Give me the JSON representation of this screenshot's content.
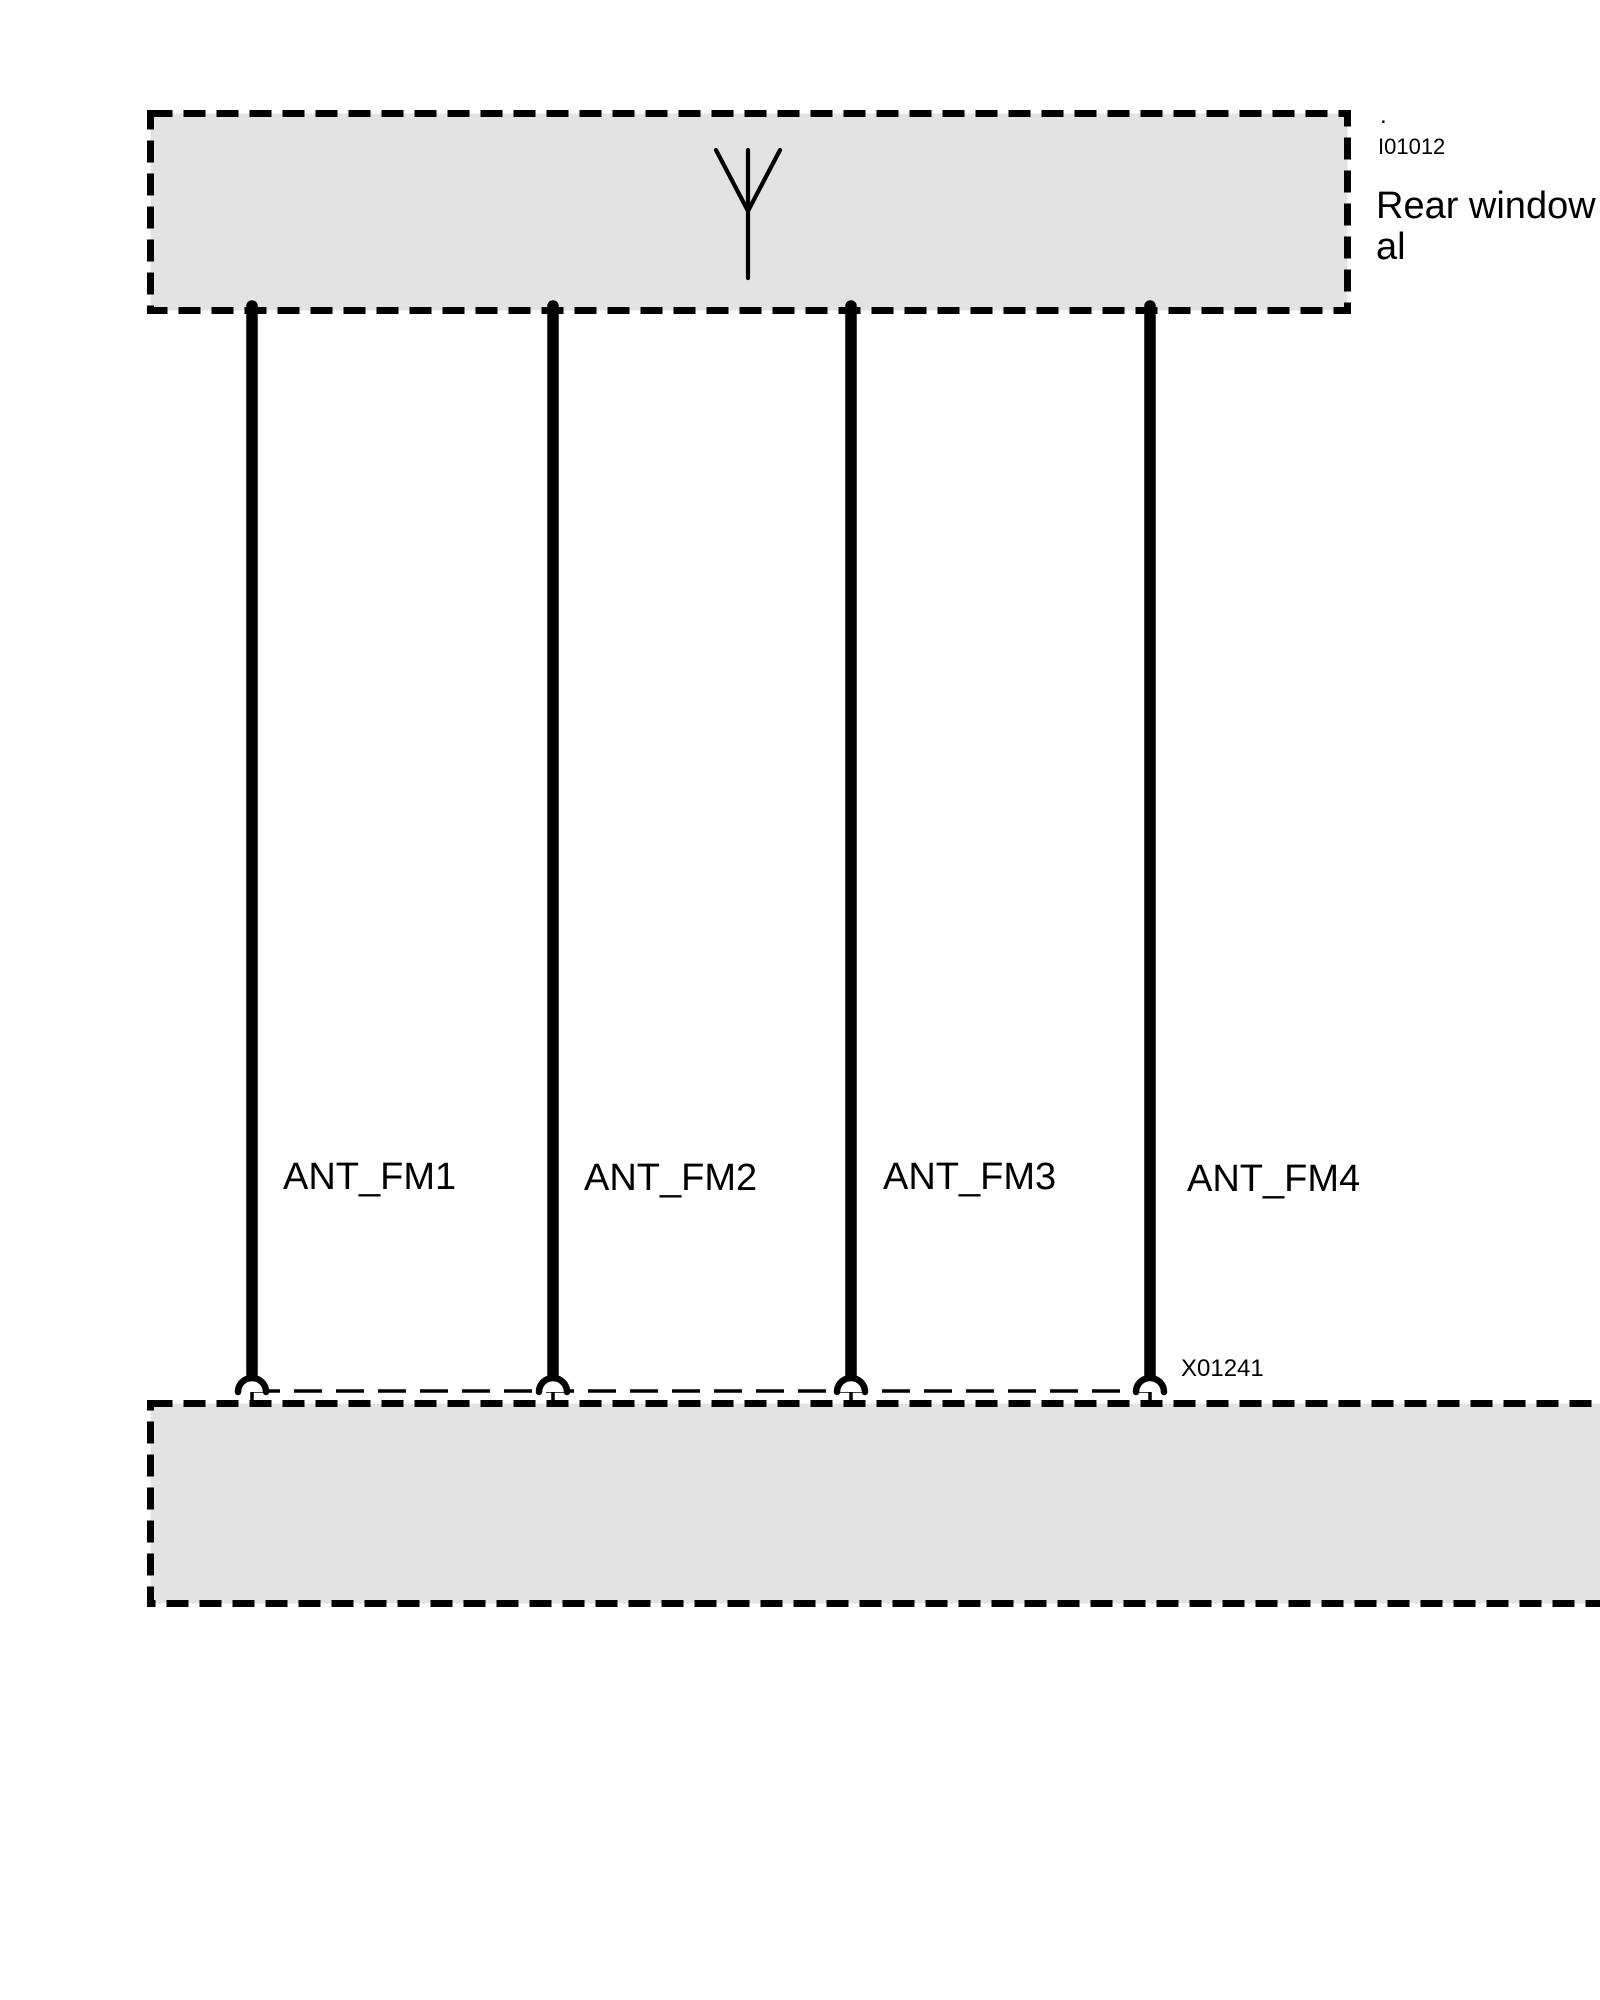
{
  "diagram": {
    "colors": {
      "background": "#ffffff",
      "box_fill": "#e3e3e3",
      "line": "#000000"
    },
    "top_component": {
      "icon": "antenna-icon",
      "ref_mark": ".",
      "ref_id": "I01012",
      "name_line1": "Rear window",
      "name_line2": "al"
    },
    "wires": [
      {
        "label": "ANT_FM1"
      },
      {
        "label": "ANT_FM2"
      },
      {
        "label": "ANT_FM3"
      },
      {
        "label": "ANT_FM4"
      }
    ],
    "connector": {
      "id": "X01241"
    },
    "bottom_component": {}
  }
}
